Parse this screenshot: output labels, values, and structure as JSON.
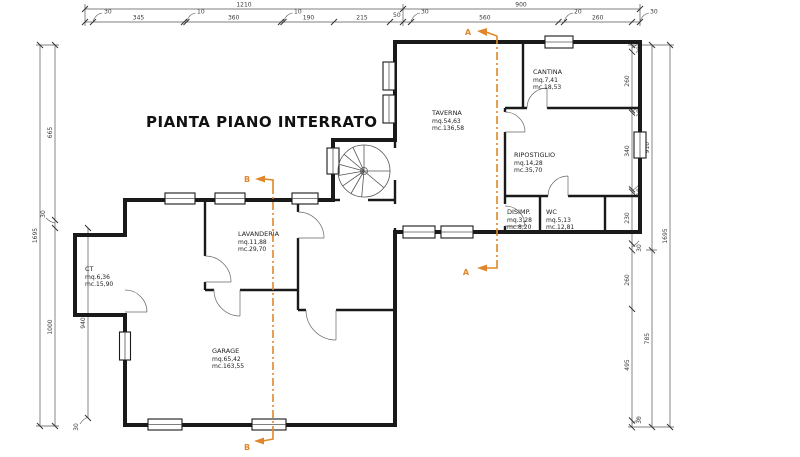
{
  "title": "PIANTA PIANO INTERRATO",
  "rooms": {
    "ct": {
      "name": "CT",
      "mq": "mq.6,36",
      "mc": "mc.15,90"
    },
    "lavanderia": {
      "name": "LAVANDERIA",
      "mq": "mq.11,88",
      "mc": "mc.29,70"
    },
    "garage": {
      "name": "GARAGE",
      "mq": "mq.65,42",
      "mc": "mc.163,55"
    },
    "taverna": {
      "name": "TAVERNA",
      "mq": "mq.54,63",
      "mc": "mc.136,58"
    },
    "cantina": {
      "name": "CANTINA",
      "mq": "mq.7,41",
      "mc": "mc.18,53"
    },
    "ripostiglio": {
      "name": "RIPOSTIGLIO",
      "mq": "mq.14,28",
      "mc": "mc.35,70"
    },
    "disimp": {
      "name": "DISIMP.",
      "mq": "mq.3,28",
      "mc": "mc.8,20"
    },
    "wc": {
      "name": "WC",
      "mq": "mq.5,13",
      "mc": "mc.12,81"
    }
  },
  "sections": {
    "a": "A",
    "b": "B"
  },
  "dims": {
    "top": {
      "left_total": "1210",
      "right_total": "900",
      "tl": [
        "30",
        "345",
        "10",
        "360",
        "10",
        "190",
        "215",
        "50"
      ],
      "tr": [
        "30",
        "560",
        "20",
        "260",
        "30"
      ]
    },
    "left": {
      "outer": "1695",
      "seg": [
        "665",
        "30",
        "1000"
      ],
      "inner": "940",
      "inner_lead": "30"
    },
    "right": {
      "outer": "1695",
      "mid": [
        "910",
        "785"
      ],
      "seg": [
        "30",
        "260",
        "10",
        "340",
        "10",
        "230",
        "30",
        "260",
        "495",
        "30"
      ]
    }
  },
  "colors": {
    "section_line": "#E0872B",
    "wall": "#1a1a1a",
    "dim": "#555555"
  }
}
